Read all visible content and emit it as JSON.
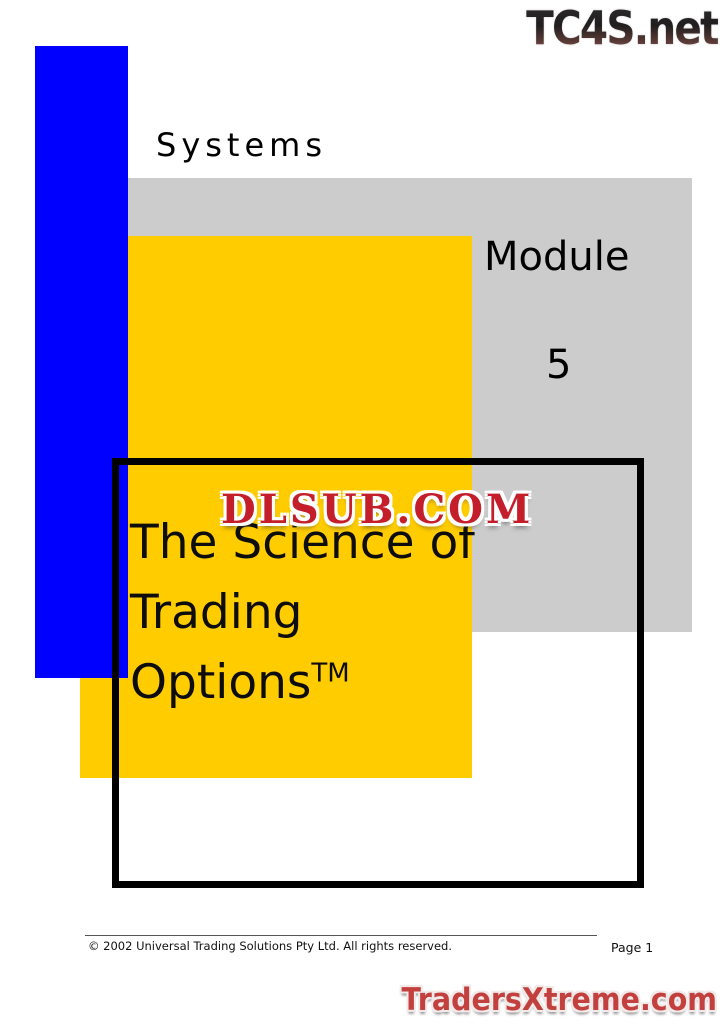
{
  "page": {
    "kicker": "Systems",
    "module_label": "Module",
    "module_number": "5",
    "title_line1": "The Science of Trading",
    "title_line2": "Options",
    "title_trademark": "TM"
  },
  "watermarks": {
    "top_logo": "TC4S.net",
    "center_watermark": "DLSUB.COM",
    "bottom_logo": "TradersXtreme.com"
  },
  "footer": {
    "copyright": "© 2002 Universal Trading Solutions Pty Ltd. All rights reserved.",
    "page_label": "Page 1"
  },
  "colors": {
    "blue_bar": "#0000fe",
    "yellow_panel": "#ffcc00",
    "gray_panel": "#cccccc",
    "frame": "#000000",
    "watermark_red": "#c41e2a",
    "bottom_logo_red": "#c2413f"
  }
}
